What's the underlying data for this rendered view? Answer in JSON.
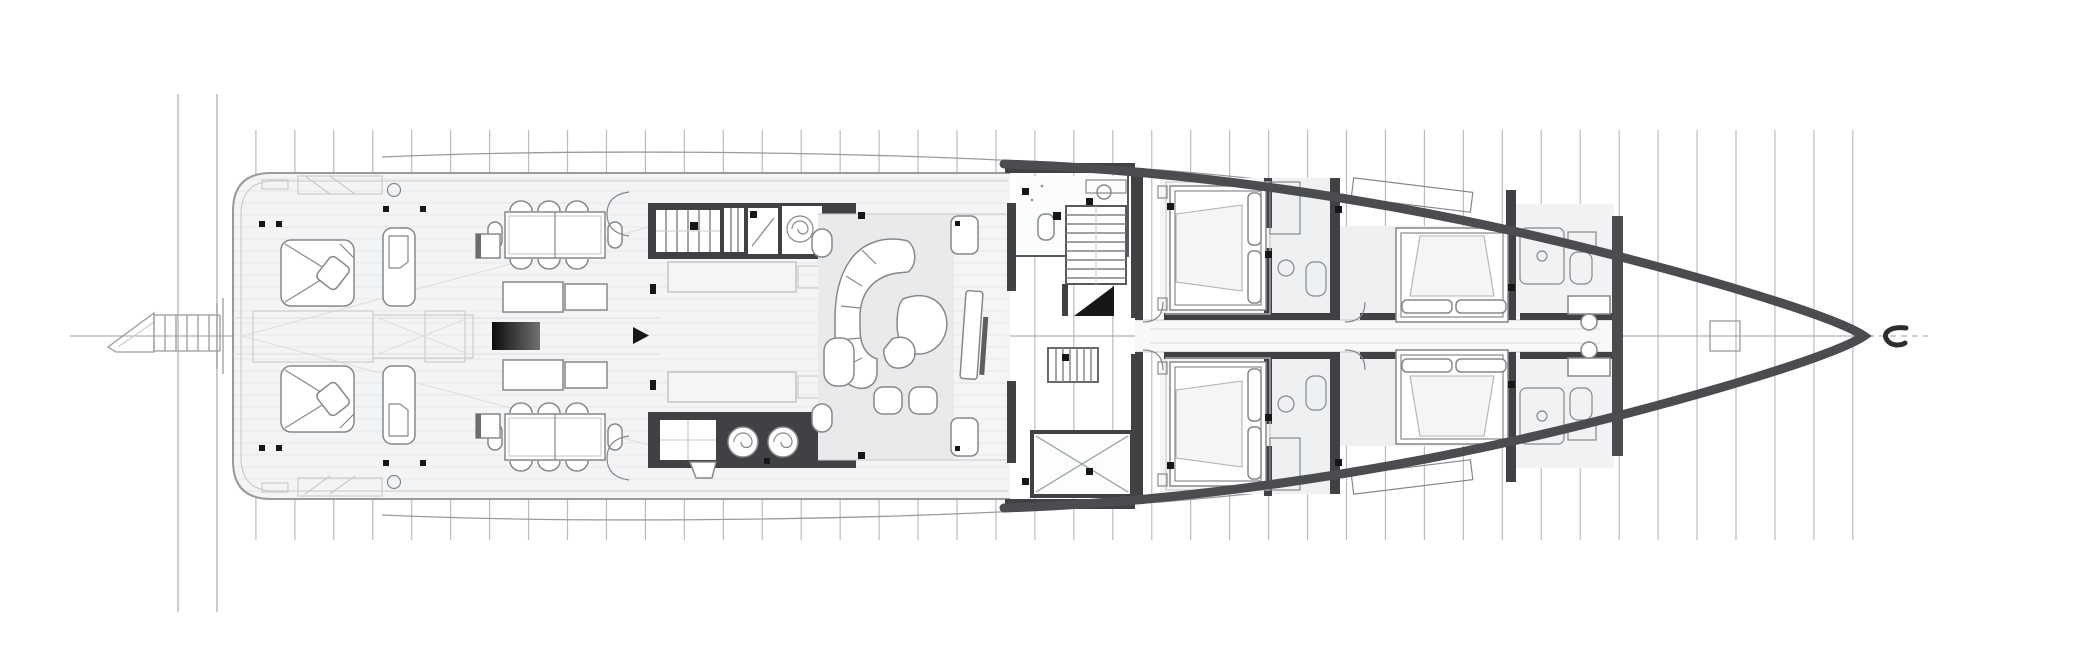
{
  "meta": {
    "drawing": "yacht-general-arrangement-deck-plan",
    "view": "top-down",
    "bow_direction": "right",
    "visible_text": "none"
  },
  "canvas": {
    "width": 2097,
    "height": 672,
    "viewbox": "0 0 2097 672",
    "background": "#ffffff"
  },
  "palette": {
    "bg": "#ffffff",
    "grid": "#b9bcbf",
    "gridLong": "#a7aaad",
    "centerline": "#9aa0a4",
    "hull": "#4a4c4f",
    "wall": "#3f4144",
    "outline": "#989b9e",
    "furniture": "#85888b",
    "floorLight": "#f3f4f5",
    "floorMid": "#e9eaec",
    "floorGray": "#efeff1",
    "bathGray": "#eef0f2",
    "accent": "#161718",
    "plank": "#e7e8ea",
    "consoleGradientStart": "#0c0c0d",
    "consoleGradientEnd": "#6f7173"
  },
  "grid": {
    "line_count": 44,
    "x_start": 178,
    "x_step": 38.95,
    "y_top": 130,
    "y_bottom": 540,
    "long_line_indices": [
      0,
      1
    ],
    "long_y_top": 94,
    "long_y_bottom": 612
  },
  "centerline": {
    "y": 336,
    "x_start": 70,
    "x_end": 1868,
    "dash_x_start": 1868,
    "dash_x_end": 1928
  },
  "zones": {
    "aft": [
      "swim-platform",
      "boarding-ladder",
      "sun-pad-port",
      "sun-pad-starboard",
      "lounge-chair-port",
      "lounge-chair-starboard",
      "deck-hatches",
      "dining-table-port",
      "dining-table-starboard",
      "sideboard-port",
      "sideboard-starboard",
      "media-console"
    ],
    "midship": [
      "galley-port-counter",
      "galley-starboard-counter",
      "galley-islands",
      "stove-burners",
      "service-stairs",
      "salon-sofa",
      "coffee-tables",
      "poufs",
      "tv-cabinet"
    ],
    "lobby": [
      "day-head",
      "main-staircase",
      "under-stair-void",
      "service-stair",
      "service-lift"
    ],
    "cabins": [
      "guest-cabin-aft-port",
      "guest-cabin-aft-starboard",
      "guest-cabin-fwd-port",
      "guest-cabin-fwd-starboard",
      "guest-corridor",
      "ensuite-bathrooms",
      "vanity-desks"
    ],
    "bow": [
      "collision-bulkhead",
      "forepeak",
      "windlass-box",
      "bow-marker"
    ]
  },
  "furniture_counts": {
    "frame_lines": 44,
    "sun_pads": 2,
    "lounge_chairs": 2,
    "dining_tables": 2,
    "stove_burners": 2,
    "guest_cabins": 4,
    "double_beds": 4,
    "stair_runs": 3
  }
}
